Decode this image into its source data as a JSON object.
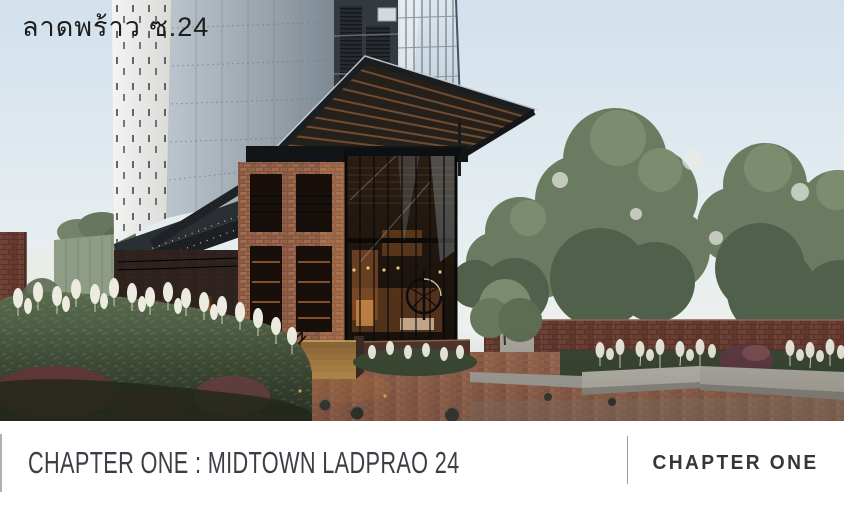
{
  "photo_overlay": {
    "location_label": "ลาดพร้าว ซ.24"
  },
  "caption_bar": {
    "title": "CHAPTER ONE : MIDTOWN LADPRAO 24",
    "brand_logo": "CHAPTER ONE"
  },
  "colors": {
    "caption_background": "#ffffff",
    "caption_text": "#3b3f45",
    "brand_text": "#33373c",
    "divider": "#9c9c9c",
    "overlay_text": "#1d1d1b",
    "sky": "#dce8f0",
    "canopy_wood": "#7a5134",
    "brick": "#8a5a43",
    "interior_glow": "#c98a46"
  }
}
